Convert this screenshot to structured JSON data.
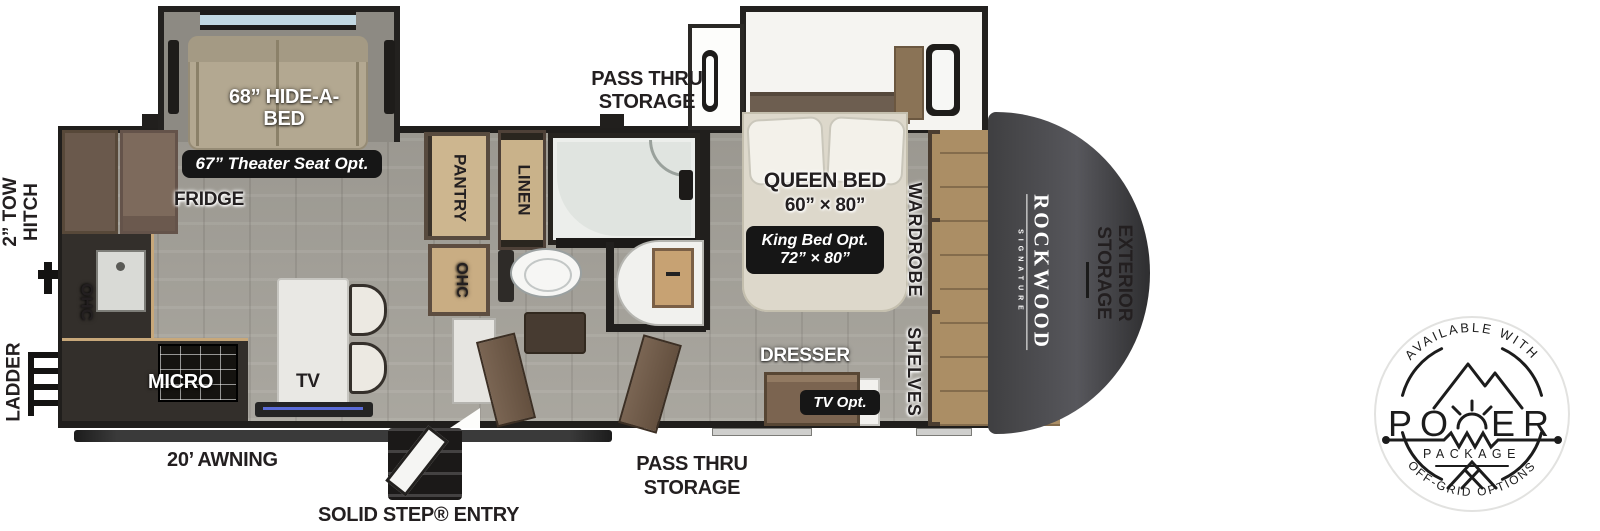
{
  "brand": {
    "name": "ROCKWOOD",
    "sub": "SIGNATURE"
  },
  "exterior": {
    "tow_hitch": {
      "line1": "2” TOW",
      "line2": "HITCH"
    },
    "ladder": "LADDER",
    "awning": "20’ AWNING",
    "solid_step_entry": "SOLID STEP® ENTRY",
    "pass_thru_top": {
      "line1": "PASS THRU",
      "line2": "STORAGE"
    },
    "pass_thru_bottom": {
      "line1": "PASS THRU",
      "line2": "STORAGE"
    },
    "exterior_storage": {
      "line1": "EXTERIOR",
      "line2": "STORAGE"
    }
  },
  "interior": {
    "hide_a_bed": {
      "line1": "68” HIDE-A-",
      "line2": "BED"
    },
    "theater_opt": "67” Theater Seat Opt.",
    "fridge": "FRIDGE",
    "pantry": "PANTRY",
    "linen": "LINEN",
    "ohc_pantry": "OHC",
    "ohc_kitchen": "OHC",
    "micro": "MICRO",
    "tv": "TV",
    "queen_bed": {
      "line1": "QUEEN BED",
      "line2": "60” × 80”"
    },
    "king_opt": {
      "line1": "King Bed Opt.",
      "line2": "72” × 80”"
    },
    "wardrobe": "WARDROBE",
    "shelves": "SHELVES",
    "dresser": "DRESSER",
    "tv_opt": "TV Opt."
  },
  "badge": {
    "arc_top": "AVAILABLE WITH",
    "power_left": "PO",
    "power_right": "ER",
    "package": "PACKAGE",
    "arc_bottom": "OFF-GRID OPTIONS"
  },
  "colors": {
    "label": "#231f20",
    "wall": "#211f1d",
    "floor": "#a6a39b",
    "pill_bg": "#161616",
    "wood_light": "#c9ad83",
    "wood_mid": "#9c7f58",
    "cabinet_brown": "#7d6a5c",
    "sofa": "#b3a891",
    "mattress": "#ddd8cb",
    "front_cap": "#48484b"
  }
}
